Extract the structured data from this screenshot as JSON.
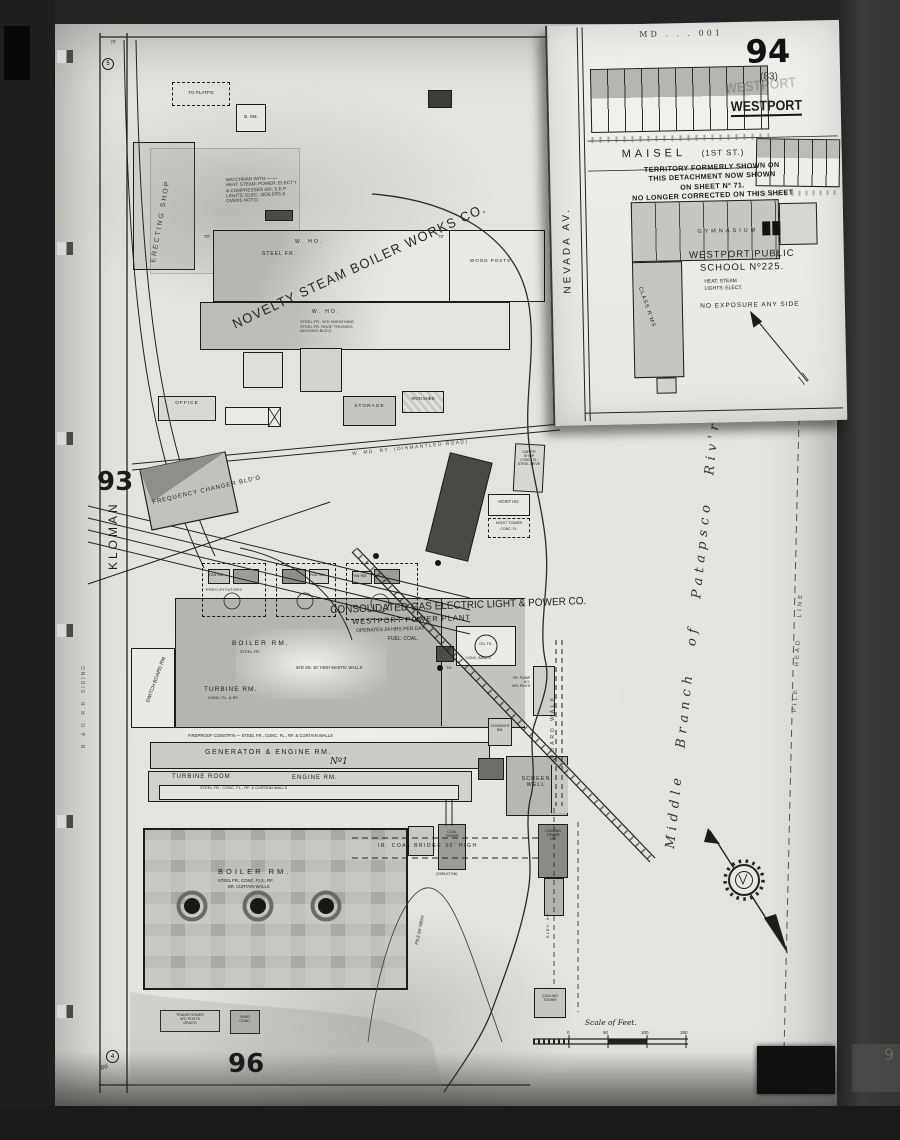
{
  "inset": {
    "md_code": "MD . . . 001",
    "sheet_number": "94",
    "sheet_alt": "(83)",
    "title": "WESTPORT",
    "title_ghost": "WESTPORT",
    "street_maisel": "MAISEL",
    "street_maisel_sub": "(1ST ST.)",
    "nevada_av": "NEVADA AV.",
    "territory_note": [
      "TERRITORY FORMERLY SHOWN ON",
      "THIS DETACHMENT NOW SHOWN",
      "ON SHEET Nº 71.",
      "NO LONGER CORRECTED ON THIS SHEET"
    ],
    "gymnasium": "GYMNASIUM",
    "class_rms": "CLASS R'MS",
    "school_line1": "WESTPORT PUBLIC",
    "school_line2": "SCHOOL Nº225.",
    "school_heat": "HEAT: STEAM",
    "school_lights": "LIGHTS: ELECT.",
    "school_exposure": "NO EXPOSURE ANY SIDE"
  },
  "sheets": {
    "left": "93",
    "bottom": "96"
  },
  "streets": {
    "kloman": "KLOMAN",
    "bo_siding": "B. & O. R.R. SIDING",
    "railway_dismantled": "W. MD. RY. (DISMANTLED ROAD)",
    "board_walk": "BOARD WALK",
    "pile_head_line": "PILE HEAD LINE"
  },
  "river": {
    "label": "Middle Branch of Patapsco Riv'r"
  },
  "novelty": {
    "name": "NOVELTY STEAM BOILER WORKS CO.",
    "w_ho": "W. HO.",
    "steel_fr": "STEEL FR.",
    "wood_posts": "WOOD POSTS",
    "w_ho2": "W. HO.",
    "sheath1": "STEEL FR., W'D SHEATHING",
    "sheath2": "STEEL FR. ROOF TRUSSES",
    "sheath3": "ADJOIN'G BLD'G",
    "office": "OFFICE",
    "storage": "STORAGE",
    "iron_shed": "IRON SHED",
    "to_platfd": "TO PLATF'D",
    "b_sm": "B. SM.",
    "erecting_shop": "ERECTING SHOP",
    "dim70a": "70'",
    "dim70b": "70'"
  },
  "notes": {
    "watchman": [
      "WATCHMAN WITH —·—",
      "HEAT: STEAM; POWER: ELECT'Y",
      "& COMPRESSED AIR; S.E.P.",
      "LIGHTS: ELEC.; BOILERS &",
      "OVENS NOT'D."
    ]
  },
  "frequency": {
    "label": "FREQUENCY CHANGER BLD'G"
  },
  "power": {
    "title": "CONSOLIDATED GAS ELECTRIC LIGHT & POWER CO.",
    "subtitle": "WESTPORT POWER PLANT",
    "operates": "OPERATES 24 HRS PER DAY",
    "fuel": "FUEL: COAL.",
    "switch_board": "SWITCH BOARD RM.",
    "boiler_up": "BOILER RM.",
    "boiler_up_sub": "STEEL FR.",
    "mastic": "W'D SD. 30' HIGH MASTIC WALLS",
    "turbine_rm": "TURBINE RM.",
    "turbine_sub": "CONC. FL. & RF.",
    "fireproof": "FIREPROOF CONSTR'N — STEEL FR., CONC. FL., RF. & CURTAIN WALLS",
    "generator": "GENERATOR & ENGINE RM.",
    "no1": "Nº1",
    "turbine_room": "TURBINE ROOM",
    "engine_rm": "ENGINE RM.",
    "strip_sub": "STEEL FR., CONC. FL., RF. & CURTAIN WALLS",
    "boiler_big": "BOILER RM.",
    "boiler_sub1": "STEEL FR., CONC. FLS., RF.",
    "boiler_sub2": "BR. CURTAIN WALLS",
    "fan_rm": "FAN RM.",
    "precipitators": "PRECIPITATORS",
    "oil_tk": "OIL TK.",
    "oil_sub": "CONC. BANK'D",
    "th": "TH.",
    "pump1": "FR. PUMP",
    "pump2": "HO.",
    "pump3": "W'D PILES",
    "cond1": "CONDEN'R",
    "cond2": "RM.",
    "screen1": "SCREEN",
    "screen2": "WELL",
    "carp1": "CARP'R",
    "carp2": "SHOP",
    "carp3": "CONC. FL.",
    "carp4": "STEEL AB'VE",
    "hoist_ho": "HOIST HO.",
    "hoist_t1": "HOIST TOWER",
    "hoist_t2": "CONC. FL.",
    "coal_bridge": "IR. COAL BRIDGE 30' HIGH",
    "coal_t1": "COAL",
    "coal_t2": "TOWER",
    "skeleton": "(SKELETON)",
    "ct2_1": "COALING",
    "ct2_2": "TOWER",
    "ct2_3": "Nº2",
    "elev": "ELEV. 60'",
    "ct4_1": "COALING",
    "ct4_2": "TOWER",
    "pile60": "PILE 60' HIGH",
    "trans1": "TRANSFORMER",
    "trans2": "W'D POSTS",
    "trans3": "GRAV'D",
    "shed1": "SHED",
    "shed2": "CONC."
  },
  "scale": {
    "title": "Scale of Feet.",
    "t0": "0",
    "t50": "50",
    "t100": "100",
    "t150": "150"
  },
  "marks": {
    "dim70_corner": "70'",
    "circ5": "5",
    "circ4": "4",
    "num86": "86",
    "edge9": "9"
  }
}
